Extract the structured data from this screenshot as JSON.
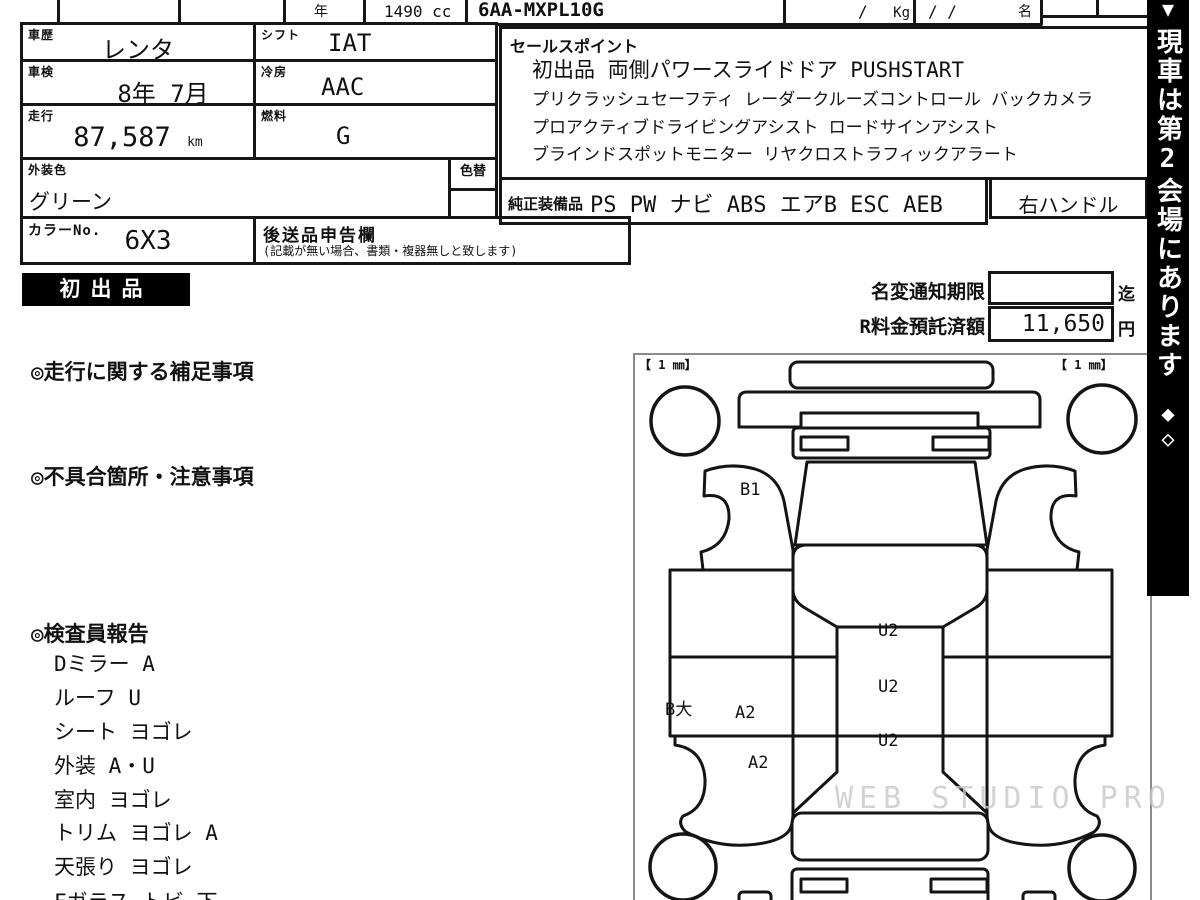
{
  "top_row": {
    "year_label": "年",
    "displacement": "1490 cc",
    "model_code": "6AA-MXPL10G",
    "weight_slash": "/",
    "weight_unit": "Kg",
    "capacity_slashes": "/ /",
    "capacity_unit": "名"
  },
  "info_table": {
    "history_label": "車歴",
    "history_value": "レンタ",
    "shift_label": "シフト",
    "shift_value": "IAT",
    "inspection_label": "車検",
    "inspection_value": "8年 7月",
    "ac_label": "冷房",
    "ac_value": "AAC",
    "mileage_label": "走行",
    "mileage_value": "87,587",
    "mileage_unit": "km",
    "fuel_label": "燃料",
    "fuel_value": "G",
    "ext_color_label": "外装色",
    "ext_color_value": "グリーン",
    "color_change_label": "色替",
    "color_no_label": "カラーNo.",
    "color_no_value": "6X3",
    "late_items_label": "後送品申告欄",
    "late_items_note": "(記載が無い場合、書類・複器無しと致します)"
  },
  "sales_point": {
    "header": "セールスポイント",
    "lines": [
      "初出品 両側パワースライドドア PUSHSTART",
      "プリクラッシュセーフティ レーダークルーズコントロール バックカメラ",
      "プロアクティブドライビングアシスト ロードサインアシスト",
      "ブラインドスポットモニター リヤクロストラフィックアラート"
    ]
  },
  "equipment": {
    "label": "純正装備品",
    "value": "PS PW ナビ ABS エアB ESC AEB",
    "steering": "右ハンドル"
  },
  "badge_first_listing": "初出品",
  "notices": {
    "name_change_label": "名変通知期限",
    "name_change_value": "",
    "name_change_suffix": "迄",
    "deposit_label": "R料金預託済額",
    "deposit_value": "11,650",
    "deposit_unit": "円"
  },
  "sections": {
    "mileage_notes": "◎走行に関する補足事項",
    "defects": "◎不具合箇所・注意事項",
    "inspector_report": "◎検査員報告"
  },
  "inspector_items": [
    "Dミラー A",
    "ルーフ U",
    "シート ヨゴレ",
    "外装 A・U",
    "室内 ヨゴレ",
    "トリム ヨゴレ A",
    "天張り ヨゴレ",
    "Fガラス トビ 下"
  ],
  "diagram": {
    "corner_left": "【 1 ㎜】",
    "corner_right": "【 1 ㎜】",
    "labels": {
      "b1": "B1",
      "b_dai": "B大",
      "a2_upper": "A2",
      "a2_lower": "A2",
      "u2_1": "U2",
      "u2_2": "U2",
      "u2_3": "U2"
    }
  },
  "side_banner": {
    "text": "現車は第2会場にあります",
    "marks": "◆◇",
    "bg_color": "#000000"
  },
  "watermark": "WEB STUDIO PRO"
}
